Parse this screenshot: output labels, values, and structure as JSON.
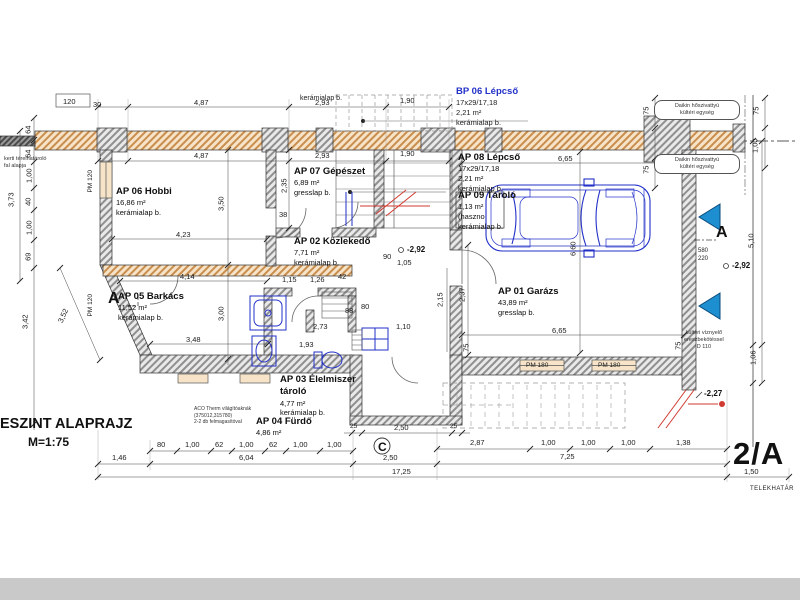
{
  "title": {
    "main": "ESZINT ALAPRAJZ",
    "scale": "M=1:75"
  },
  "sheet": {
    "code": "2/A",
    "boundary_label": "TELEKHATÁR"
  },
  "sections": {
    "a": "A",
    "c": "C"
  },
  "levels": {
    "mid": "-2,92",
    "right": "-2,92",
    "entry": "-2,27"
  },
  "rooms": [
    {
      "name": "AP 06 Hobbi",
      "area": "16,86 m²",
      "floor": "kerámialap b."
    },
    {
      "name": "AP 07 Gépészet",
      "area": "6,89 m²",
      "floor": "gresslap b."
    },
    {
      "name": "AP 08 Lépcső",
      "steps": "17x29/17,18",
      "area": "2,21 m²",
      "floor": "kerámialap b."
    },
    {
      "name": "BP 06 Lépcső",
      "steps": "17x29/17,18",
      "area": "2,21 m²",
      "floor": "kerámialap b."
    },
    {
      "name": "AP 09 Tároló",
      "area": "1,13 m²",
      "note": "(haszno",
      "floor": "kerámialap b."
    },
    {
      "name": "AP 02 Közlekedő",
      "area": "7,71 m²",
      "floor": "kerámialap b."
    },
    {
      "name": "AP 05 Barkács",
      "area": "11,52 m²",
      "floor": "kerámialap b."
    },
    {
      "name": "AP 01 Garázs",
      "area": "43,89 m²",
      "floor": "gresslap b."
    },
    {
      "name": "AP 03  Élelmiszer tároló",
      "area": "4,77 m²",
      "floor": "kerámialap b."
    },
    {
      "name": "AP 04 Fürdő",
      "area": "4,86 m²"
    }
  ],
  "fragments": {
    "top_room_floor": "kerámialap b."
  },
  "windows": {
    "pm120": "PM 120",
    "pm180": "PM 180"
  },
  "annotations": {
    "garden_wall": {
      "l1": "kerti térelhatároló",
      "l2": "fal alapja"
    },
    "daikin": {
      "l1": "Daikin hőszivattyú",
      "l2": "kültéri egység"
    },
    "drain": {
      "l1": "kültéri víznyelő",
      "l2": "ereszbekötéssel",
      "l3": "D 110"
    },
    "aco": {
      "l1": "ACO Therm világítóaknák",
      "l2": "(375012,315780)",
      "l3": "2-2 db felmagasítóval"
    }
  },
  "dims": [
    "4,87",
    "2,93",
    "1,90",
    "4,87",
    "2,93",
    "1,90",
    "6,65",
    "4,23",
    "4,14",
    "3,48",
    "6,65",
    "2,50",
    "2,50",
    "17,25",
    "1,46",
    "6,04",
    "7,25",
    "1,50",
    "80",
    "1,00",
    "62",
    "1,00",
    "62",
    "1,00",
    "1,00",
    "2,87",
    "1,00",
    "1,00",
    "1,00",
    "1,38",
    "3,73",
    "3,42",
    "3,52",
    "3,50",
    "3,00",
    "2,35",
    "2,15",
    "2,37",
    "6,60",
    "5,10",
    "1,06",
    "75",
    "75",
    "75",
    "1,00",
    "75",
    "75",
    "38",
    "2,73",
    "1,10",
    "1,93",
    "1,15",
    "1,26",
    "42",
    "88",
    "80",
    "90",
    "1,05",
    "120",
    "30",
    "580",
    "220",
    "25",
    "25",
    "64",
    "64",
    "1,00",
    "40",
    "1,00",
    "69"
  ],
  "colors": {
    "wall_hatch": "#c98e4e",
    "gray_wall": "#8f8f8f",
    "blue": "#2230c8",
    "section_blue": "#1d8fd0",
    "red": "#d03a30",
    "dim_text": "#1c1c1c"
  }
}
